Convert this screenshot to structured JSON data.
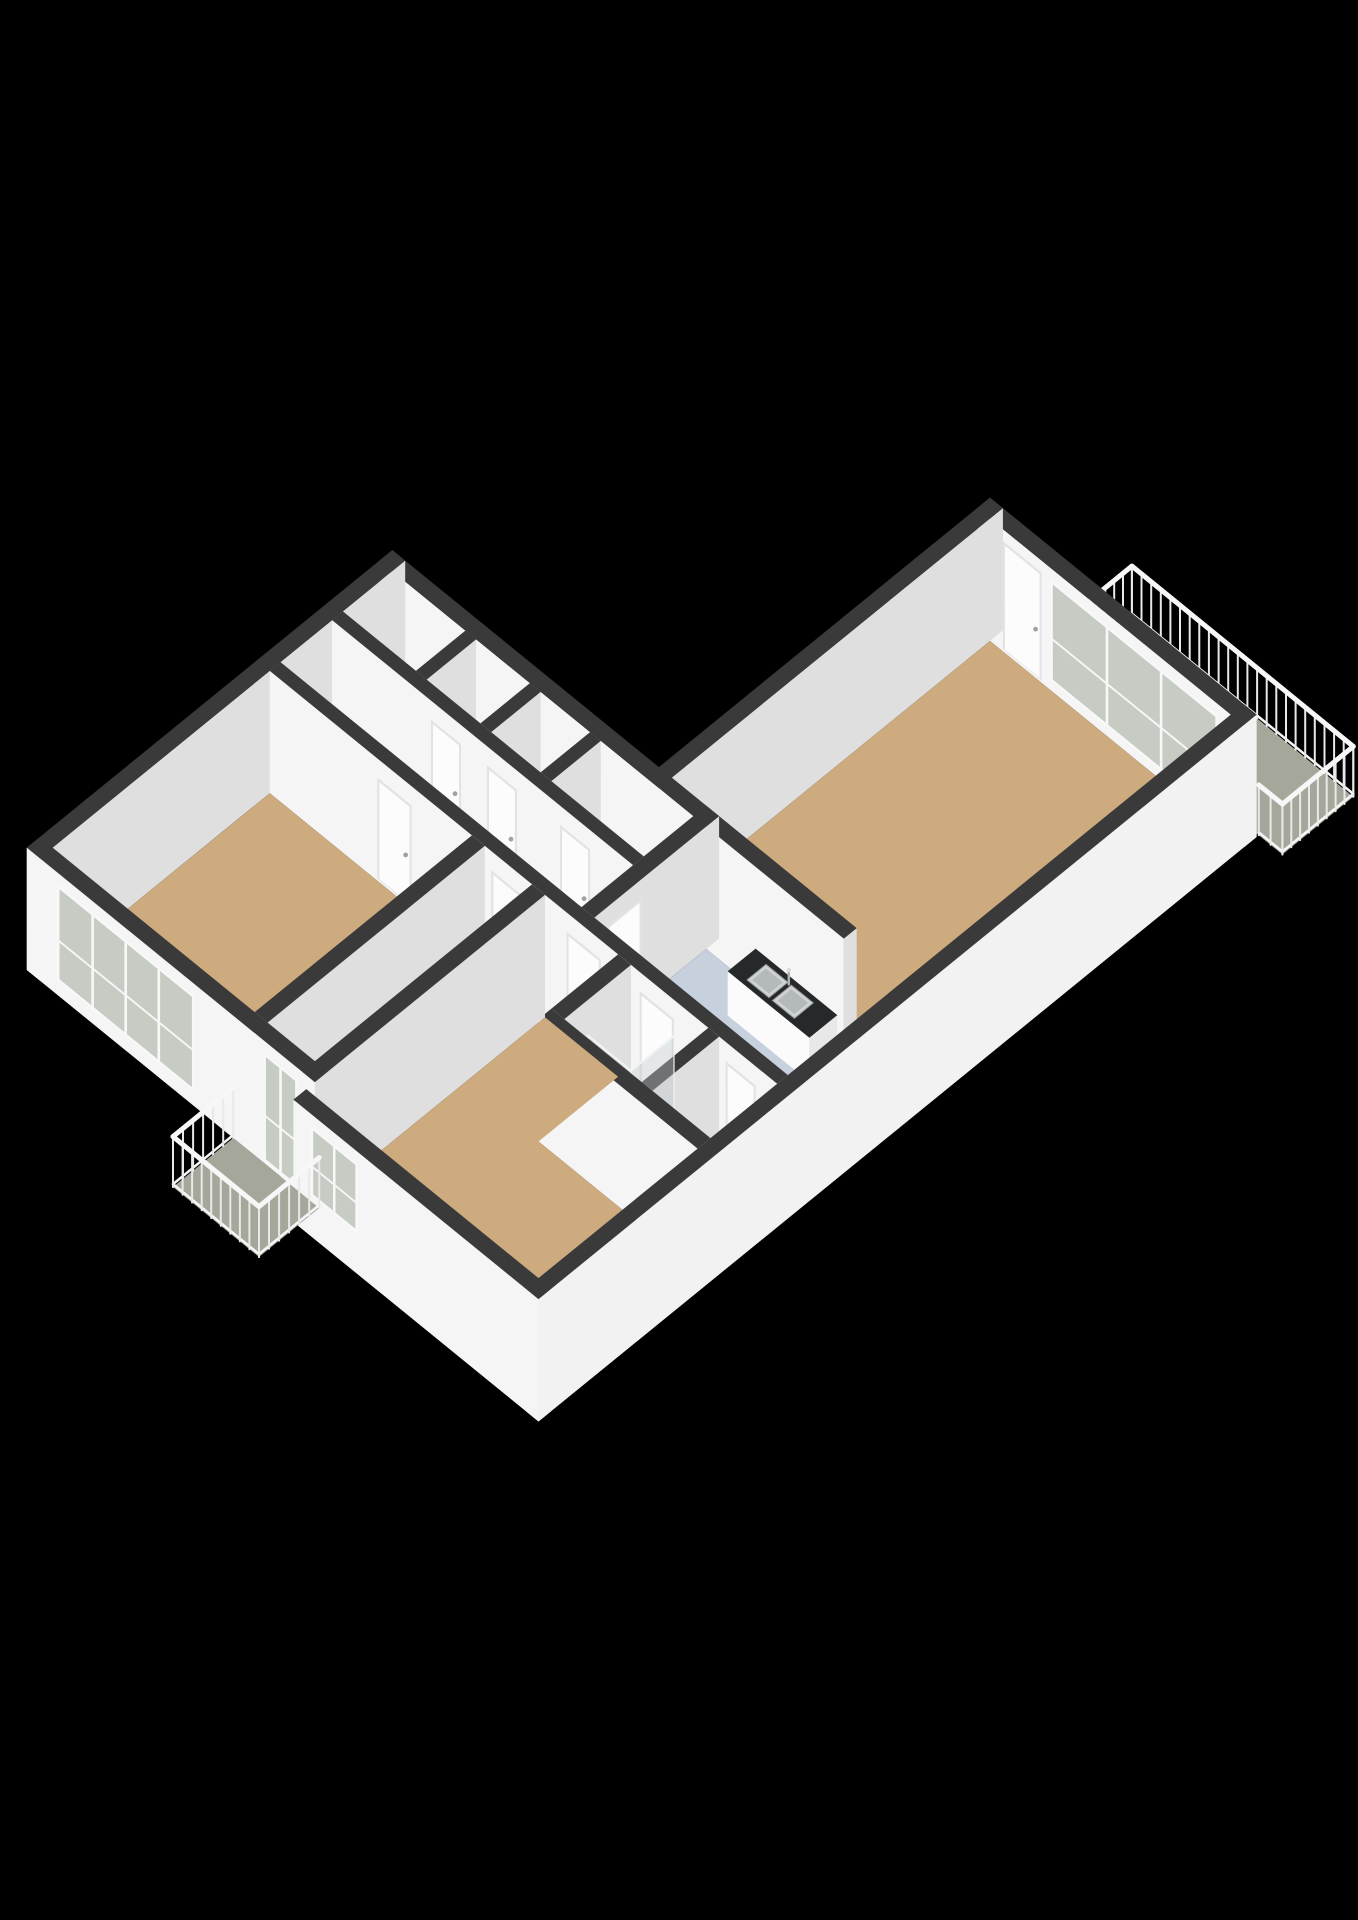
{
  "view": {
    "kind": "isometric-3d-floorplan",
    "background": "#000000",
    "width": 1358,
    "height": 1920
  },
  "camera": {
    "cx": 990,
    "cy": 620,
    "A": 43,
    "B": 35,
    "V": 48,
    "wallH": 2.55,
    "railH": 1.05
  },
  "palette": {
    "wallTop": "#3a3a3a",
    "wallY": "#f5f5f5",
    "wallX": "#dfdfdf",
    "wallXbright": "#f2f2f2",
    "tan": "#cdab7e",
    "wet": "#c7d1de",
    "toiletFloor": "#dde2e7",
    "closet": "#edeff0",
    "balcony": "#a4a79a",
    "glass": "#c6ccc4",
    "glassPane": "rgba(190,200,205,0.4)",
    "railPost": "#e9e9e9",
    "railTop": "#f7f7f7",
    "white": "#fbfbfb",
    "doorFrame": "#e3e3e3",
    "doorPanel": "#fcfcfc",
    "counterTop": "#26282a",
    "steel": "#cfd3d5",
    "steelDark": "#b4b9bb"
  },
  "scene": [
    {
      "t": "floor",
      "name": "balcony-living-floor",
      "fill": "balcony",
      "pts": [
        [
          1.6,
          -1.7
        ],
        [
          6.75,
          -1.7
        ],
        [
          6.75,
          -0.05
        ],
        [
          1.6,
          -0.05
        ]
      ]
    },
    {
      "t": "rail",
      "name": "balcony-living-rail-north",
      "x1": 1.6,
      "y1": -1.7,
      "x2": 6.75,
      "y2": -1.7
    },
    {
      "t": "rail",
      "name": "balcony-living-rail-west",
      "x1": 1.6,
      "y1": -1.7,
      "x2": 1.6,
      "y2": -0.05
    },
    {
      "t": "rail",
      "name": "balcony-living-rail-east",
      "x1": 6.75,
      "y1": -1.7,
      "x2": 6.75,
      "y2": -0.05
    },
    {
      "t": "wall",
      "name": "living-window-wall",
      "x1": 0,
      "y1": 0,
      "x2": 6.2,
      "y2": 0.3,
      "feats": [
        {
          "k": "door",
          "face": "y",
          "a": 0.6,
          "b": 1.5,
          "z0": 0.05,
          "z1": 2.3
        },
        {
          "k": "window",
          "face": "y",
          "a": 1.7,
          "b": 5.6,
          "z0": 0.2,
          "z1": 2.3,
          "m": 2
        }
      ]
    },
    {
      "t": "wall",
      "name": "living-northwest-wall",
      "x1": 0,
      "y1": 0,
      "x2": 0.3,
      "y2": 7.7
    },
    {
      "t": "floor",
      "name": "living-room-floor",
      "fill": "tan",
      "pts": [
        [
          0.3,
          0.3
        ],
        [
          5.9,
          0.3
        ],
        [
          5.9,
          7.7
        ],
        [
          0.3,
          7.7
        ]
      ]
    },
    {
      "t": "rail",
      "name": "balcony-living-rail-south",
      "x1": 6.2,
      "y1": -0.05,
      "x2": 6.75,
      "y2": -0.05
    },
    {
      "t": "wall",
      "name": "living-south-wall",
      "x1": -6.2,
      "y1": 7.7,
      "x2": 4.6,
      "y2": 8.0
    },
    {
      "t": "floor",
      "name": "closet-1-floor",
      "fill": "closet",
      "pts": [
        [
          -5.9,
          8.0
        ],
        [
          -4.2,
          8.0
        ],
        [
          -4.2,
          9.15
        ],
        [
          -5.9,
          9.15
        ]
      ]
    },
    {
      "t": "floor",
      "name": "closet-2-floor",
      "fill": "closet",
      "pts": [
        [
          -3.95,
          8.0
        ],
        [
          -2.7,
          8.0
        ],
        [
          -2.7,
          9.15
        ],
        [
          -3.95,
          9.15
        ]
      ]
    },
    {
      "t": "floor",
      "name": "closet-3-floor",
      "fill": "closet",
      "pts": [
        [
          -2.45,
          8.0
        ],
        [
          -1.3,
          8.0
        ],
        [
          -1.3,
          9.15
        ],
        [
          -2.45,
          9.15
        ]
      ]
    },
    {
      "t": "floor",
      "name": "closet-4-floor",
      "fill": "closet",
      "pts": [
        [
          -1.05,
          8.0
        ],
        [
          1.1,
          8.0
        ],
        [
          1.1,
          9.15
        ],
        [
          -1.05,
          9.15
        ]
      ]
    },
    {
      "t": "wall",
      "name": "closet-divider-1",
      "x1": -4.2,
      "y1": 8.0,
      "x2": -3.95,
      "y2": 9.15
    },
    {
      "t": "wall",
      "name": "closet-divider-2",
      "x1": -2.7,
      "y1": 8.0,
      "x2": -2.45,
      "y2": 9.15
    },
    {
      "t": "wall",
      "name": "closet-divider-3",
      "x1": -1.3,
      "y1": 8.0,
      "x2": -1.05,
      "y2": 9.15
    },
    {
      "t": "wall",
      "name": "wing-west-wall",
      "x1": -6.2,
      "y1": 7.7,
      "x2": -5.9,
      "y2": 16.2
    },
    {
      "t": "wall",
      "name": "closets-south-wall",
      "x1": -5.9,
      "y1": 9.15,
      "x2": 1.1,
      "y2": 9.4,
      "feats": [
        {
          "k": "door",
          "face": "y",
          "a": -3.6,
          "b": -2.9,
          "z0": 0.05,
          "z1": 2.15
        },
        {
          "k": "door",
          "face": "y",
          "a": -2.3,
          "b": -1.6,
          "z0": 0.05,
          "z1": 2.15
        },
        {
          "k": "door",
          "face": "y",
          "a": -0.6,
          "b": 0.1,
          "z0": 0.05,
          "z1": 2.15
        }
      ]
    },
    {
      "t": "floor",
      "name": "hallway-floor",
      "fill": "tan",
      "pts": [
        [
          -5.9,
          9.4
        ],
        [
          1.1,
          9.4
        ],
        [
          1.1,
          10.6
        ],
        [
          -5.9,
          10.6
        ]
      ]
    },
    {
      "t": "wall",
      "name": "kitchen-west-wall",
      "x1": 1.1,
      "y1": 7.7,
      "x2": 1.4,
      "y2": 10.6,
      "feats": [
        {
          "k": "door",
          "face": "x",
          "a": 9.5,
          "b": 10.3,
          "z0": 0.05,
          "z1": 2.15
        }
      ]
    },
    {
      "t": "floor",
      "name": "kitchen-floor",
      "fill": "wet",
      "pts": [
        [
          1.4,
          8.0
        ],
        [
          5.9,
          8.0
        ],
        [
          5.9,
          10.6
        ],
        [
          1.4,
          10.6
        ]
      ]
    },
    {
      "t": "box",
      "name": "kitchen-counter",
      "x1": 2.6,
      "y1": 8.05,
      "x2": 4.5,
      "y2": 8.7,
      "h": 0.92,
      "top": "counterTop",
      "yf": "white",
      "xf": "#e8e8e8"
    },
    {
      "t": "sinks",
      "name": "kitchen-sink",
      "x1": 2.95,
      "y1": 8.16,
      "x2": 4.05,
      "y2": 8.6,
      "z": 0.925
    },
    {
      "t": "box",
      "name": "kitchen-tall-unit",
      "x1": 4.95,
      "y1": 8.25,
      "x2": 5.85,
      "y2": 9.2,
      "h": 0.95,
      "top": "#f1f1f1",
      "yf": "white",
      "xf": "#e8e8e8"
    },
    {
      "t": "wall",
      "name": "hallway-south-wall",
      "x1": -5.9,
      "y1": 10.6,
      "x2": 5.9,
      "y2": 10.85,
      "feats": [
        {
          "k": "door",
          "face": "y",
          "a": -3.4,
          "b": -2.6,
          "z0": 0.05,
          "z1": 2.15
        },
        {
          "k": "door",
          "face": "y",
          "a": -0.75,
          "b": 0.05,
          "z0": 0.05,
          "z1": 2.15
        },
        {
          "k": "door",
          "face": "y",
          "a": 1.0,
          "b": 1.8,
          "z0": 0.05,
          "z1": 2.15
        },
        {
          "k": "door",
          "face": "y",
          "a": 2.7,
          "b": 3.5,
          "z0": 0.05,
          "z1": 2.15
        },
        {
          "k": "door",
          "face": "y",
          "a": 4.7,
          "b": 5.4,
          "z0": 0.05,
          "z1": 2.15
        }
      ]
    },
    {
      "t": "floor",
      "name": "bathroom-floor",
      "fill": "wet",
      "pts": [
        [
          2.5,
          10.85
        ],
        [
          4.3,
          10.85
        ],
        [
          4.3,
          12.4
        ],
        [
          2.5,
          12.4
        ]
      ]
    },
    {
      "t": "floor",
      "name": "toilet-room-floor",
      "fill": "toiletFloor",
      "pts": [
        [
          4.55,
          10.85
        ],
        [
          5.9,
          10.85
        ],
        [
          5.9,
          12.4
        ],
        [
          4.55,
          12.4
        ]
      ]
    },
    {
      "t": "wall",
      "name": "bedroom2-arm-east-wall",
      "x1": 2.2,
      "y1": 10.85,
      "x2": 2.5,
      "y2": 12.4
    },
    {
      "t": "wall",
      "name": "bathroom-toilet-divider",
      "x1": 4.3,
      "y1": 10.85,
      "x2": 4.55,
      "y2": 12.4
    },
    {
      "t": "box",
      "name": "shower-tray",
      "x1": 2.6,
      "y1": 10.95,
      "x2": 3.6,
      "y2": 11.95,
      "h": 0.08,
      "top": "#eef0f2",
      "yf": "white",
      "xf": "#e2e4e6"
    },
    {
      "t": "glass",
      "name": "shower-glass-side",
      "x1": 3.6,
      "y1": 10.95,
      "x2": 3.6,
      "y2": 11.95,
      "h": 1.95
    },
    {
      "t": "glass",
      "name": "shower-glass-front",
      "x1": 2.6,
      "y1": 11.95,
      "x2": 3.6,
      "y2": 11.95,
      "h": 1.95
    },
    {
      "t": "box",
      "name": "boiler",
      "x1": 4.7,
      "y1": 11.45,
      "x2": 5.4,
      "y2": 12.25,
      "h": 1.1,
      "top": "#f3f3f3",
      "yf": "white",
      "xf": "#e6e6e6"
    },
    {
      "t": "dot",
      "name": "boiler-cap-1",
      "x": 4.93,
      "y": 11.85,
      "z": 1.1,
      "r": 4.5,
      "fill": "#45484b"
    },
    {
      "t": "dot",
      "name": "boiler-cap-2",
      "x": 5.17,
      "y": 11.85,
      "z": 1.1,
      "r": 4.5,
      "fill": "#45484b"
    },
    {
      "t": "wall",
      "name": "bathroom-south-wall",
      "x1": 2.2,
      "y1": 12.4,
      "x2": 5.9,
      "y2": 12.7
    },
    {
      "t": "floor",
      "name": "balcony-passage-floor",
      "fill": "tan",
      "pts": [
        [
          -0.9,
          10.85
        ],
        [
          0.2,
          10.85
        ],
        [
          0.2,
          15.9
        ],
        [
          -0.9,
          15.9
        ]
      ]
    },
    {
      "t": "floor",
      "name": "bedroom1-floor",
      "fill": "tan",
      "pts": [
        [
          -5.9,
          10.85
        ],
        [
          -1.2,
          10.85
        ],
        [
          -1.2,
          15.9
        ],
        [
          -5.9,
          15.9
        ]
      ]
    },
    {
      "t": "wall",
      "name": "bedroom1-east-wall",
      "x1": -1.2,
      "y1": 10.85,
      "x2": -0.9,
      "y2": 15.9
    },
    {
      "t": "wall",
      "name": "bedroom2-west-wall",
      "x1": 0.2,
      "y1": 10.85,
      "x2": 0.5,
      "y2": 16.7
    },
    {
      "t": "floor",
      "name": "bedroom2-floor",
      "fill": "tan",
      "pts": [
        [
          0.5,
          10.85
        ],
        [
          2.2,
          10.85
        ],
        [
          2.2,
          12.7
        ],
        [
          5.9,
          12.7
        ],
        [
          5.9,
          16.4
        ],
        [
          0.5,
          16.4
        ]
      ]
    },
    {
      "t": "wall",
      "name": "wing-south-wall",
      "x1": -6.2,
      "y1": 15.9,
      "x2": 0.5,
      "y2": 16.2,
      "feats": [
        {
          "k": "window",
          "face": "y",
          "a": -5.5,
          "b": -2.3,
          "z0": 0.3,
          "z1": 2.3,
          "m": 3
        },
        {
          "k": "glassdoor",
          "face": "y",
          "a": -0.7,
          "b": 0.1,
          "z0": 0.05,
          "z1": 2.3
        }
      ]
    },
    {
      "t": "wall",
      "name": "bedroom2-south-wall",
      "x1": 0.5,
      "y1": 16.4,
      "x2": 6.2,
      "y2": 16.7,
      "feats": [
        {
          "k": "window",
          "face": "y",
          "a": 0.9,
          "b": 2.0,
          "z0": 0.85,
          "z1": 2.3,
          "m": 1
        }
      ]
    },
    {
      "t": "floor",
      "name": "balcony-small-floor",
      "fill": "balcony",
      "pts": [
        [
          -1.4,
          16.2
        ],
        [
          0.6,
          16.2
        ],
        [
          0.6,
          17.6
        ],
        [
          -1.4,
          17.6
        ]
      ]
    },
    {
      "t": "rail",
      "name": "balcony-small-rail-west",
      "x1": -1.4,
      "y1": 16.2,
      "x2": -1.4,
      "y2": 17.6
    },
    {
      "t": "rail",
      "name": "balcony-small-rail-south",
      "x1": -1.4,
      "y1": 17.6,
      "x2": 0.6,
      "y2": 17.6
    },
    {
      "t": "rail",
      "name": "balcony-small-rail-east",
      "x1": 0.6,
      "y1": 16.2,
      "x2": 0.6,
      "y2": 17.6
    },
    {
      "t": "wall",
      "name": "southeast-exterior-wall",
      "x1": 5.9,
      "y1": 0,
      "x2": 6.2,
      "y2": 16.7,
      "xf": "wallXbright"
    }
  ]
}
